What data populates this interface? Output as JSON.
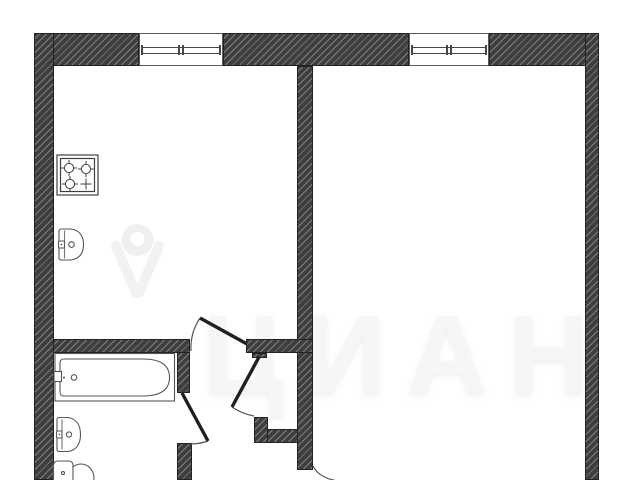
{
  "watermark": {
    "brand_text": "ЦИАН",
    "logo_icon": "cian-pin-icon"
  },
  "floorplan": {
    "kind": "apartment-floor-plan",
    "icons": [
      "stove-icon",
      "kitchen-sink-icon",
      "bathtub-icon",
      "bathroom-sink-icon",
      "toilet-icon",
      "window-icon",
      "window-icon",
      "door-arc-icon",
      "door-arc-icon",
      "door-arc-icon",
      "door-arc-icon"
    ],
    "window_count": 2,
    "door_count": 4
  },
  "colors": {
    "background": "#ffffff",
    "wall_fill": "#3e3e3e",
    "wall_hatch": "#8c8c8c",
    "fixture_line": "#555555",
    "door_leaf": "#1f1f1f",
    "watermark": "#f6f6f6"
  }
}
